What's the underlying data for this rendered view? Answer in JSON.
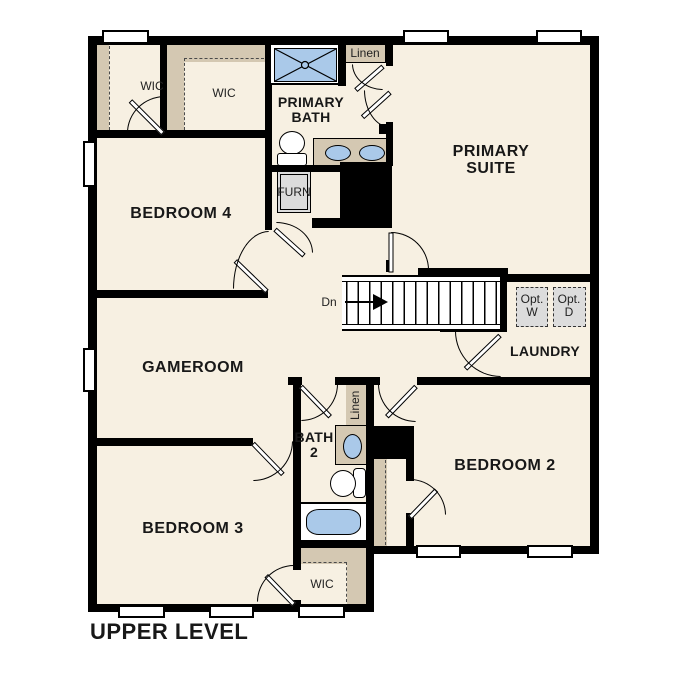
{
  "title": "UPPER LEVEL",
  "rooms": {
    "primary_suite": "PRIMARY SUITE",
    "primary_bath": "PRIMARY BATH",
    "bedroom4": "BEDROOM 4",
    "bedroom3": "BEDROOM 3",
    "bedroom2": "BEDROOM 2",
    "gameroom": "GAMEROOM",
    "laundry": "LAUNDRY",
    "bath2": "BATH 2",
    "wic1": "WIC",
    "wic2": "WIC",
    "wic3": "WIC",
    "linen1": "Linen",
    "linen2": "Linen",
    "furnace": "FURN"
  },
  "stairs": {
    "down_label": "Dn"
  },
  "laundry_options": {
    "washer": "Opt. W",
    "dryer": "Opt. D"
  },
  "colors": {
    "floor": "#f7f0e2",
    "closet_tan": "#d4c8b2",
    "fixture_blue": "#aac9e9",
    "appliance_grey": "#dcdcdc",
    "wall": "#000000",
    "text": "#181818"
  },
  "fixtures": [
    "shower",
    "double-vanity",
    "toilet",
    "bathtub",
    "sink",
    "furnace",
    "optional-washer",
    "optional-dryer"
  ]
}
